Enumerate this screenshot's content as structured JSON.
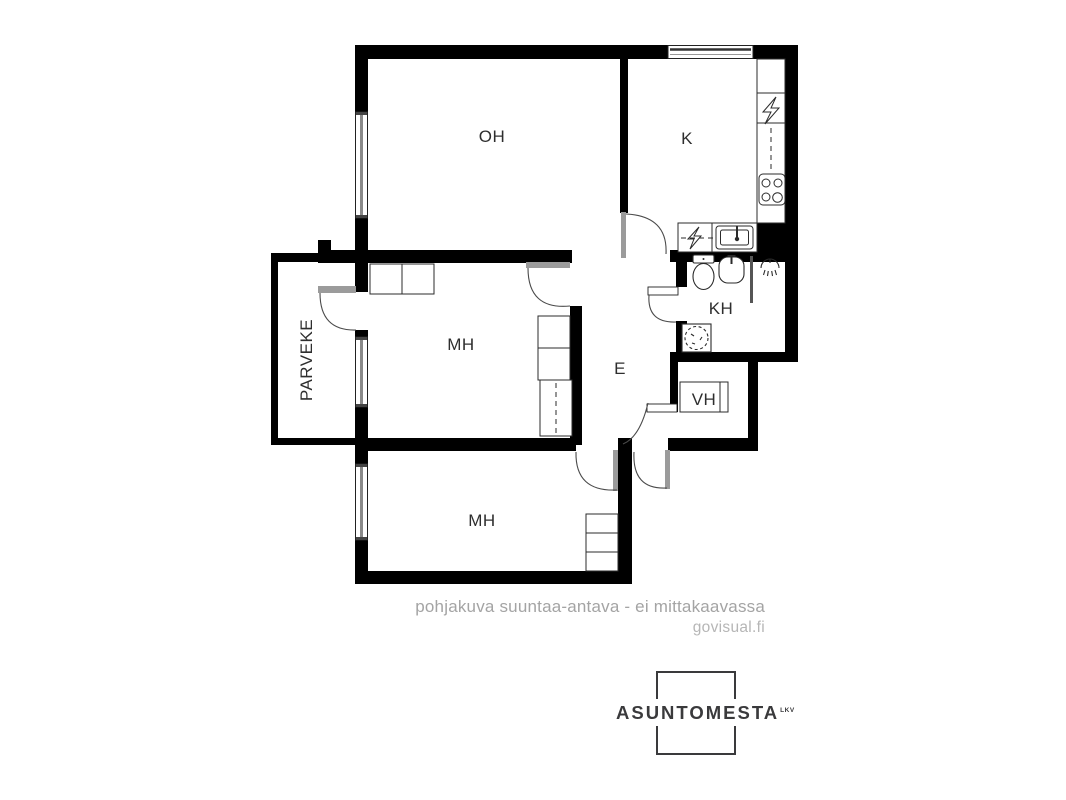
{
  "plan": {
    "type": "apartment-floorplan",
    "rooms": [
      {
        "id": "oh",
        "label": "OH"
      },
      {
        "id": "k",
        "label": "K"
      },
      {
        "id": "mh_mid",
        "label": "MH"
      },
      {
        "id": "e",
        "label": "E"
      },
      {
        "id": "kh",
        "label": "KH"
      },
      {
        "id": "vh",
        "label": "VH"
      },
      {
        "id": "mh_bot",
        "label": "MH"
      },
      {
        "id": "parveke",
        "label": "PARVEKE"
      }
    ],
    "fixture_icons": [
      "window",
      "door-swing-arc",
      "toilet-icon",
      "washbasin-icon",
      "shower-icon",
      "stove-icon",
      "refrigerator-lightning-icon",
      "dishwasher-lightning-icon",
      "sink-icon",
      "washing-machine-icon",
      "wardrobe-icon"
    ]
  },
  "footer": {
    "disclaimer": "pohjakuva suuntaa-antava - ei mittakaavassa",
    "watermark": "govisual.fi"
  },
  "logo": {
    "name": "ASUNTOMESTA",
    "suffix": "LKV"
  },
  "colors": {
    "background": "#ffffff",
    "wall": "#000000",
    "fixture_line": "#2b2b2b",
    "door_leaf": "#9b9b9b",
    "window_glass": "#8a8a8a",
    "footer_text": "#a4a4a4",
    "watermark_text": "#b6b6b6",
    "logo": "#3a3a3c"
  }
}
